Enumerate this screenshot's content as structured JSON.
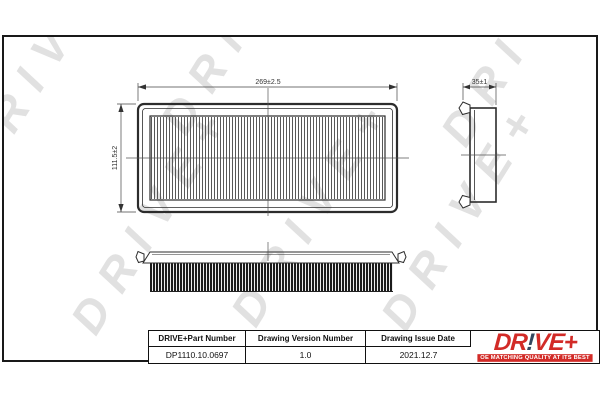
{
  "sheet": {
    "watermark_text": "DRIVE+",
    "watermark_color": "#e1e1e1"
  },
  "dimensions": {
    "top_view_width": "269±2.5",
    "top_view_height": "111.5±2",
    "side_view_depth": "35±1"
  },
  "title_block": {
    "part_number_header": "DRIVE+Part Number",
    "part_number_value": "DP1110.10.0697",
    "version_header": "Drawing Version Number",
    "version_value": "1.0",
    "issue_date_header": "Drawing Issue Date",
    "issue_date_value": "2021.12.7"
  },
  "logo": {
    "prefix": "DR",
    "bang": "!",
    "suffix": "VE+",
    "tagline": "OE MATCHING QUALITY AT ITS BEST",
    "brand_red": "#d22b27",
    "bang_color": "#33475f"
  }
}
